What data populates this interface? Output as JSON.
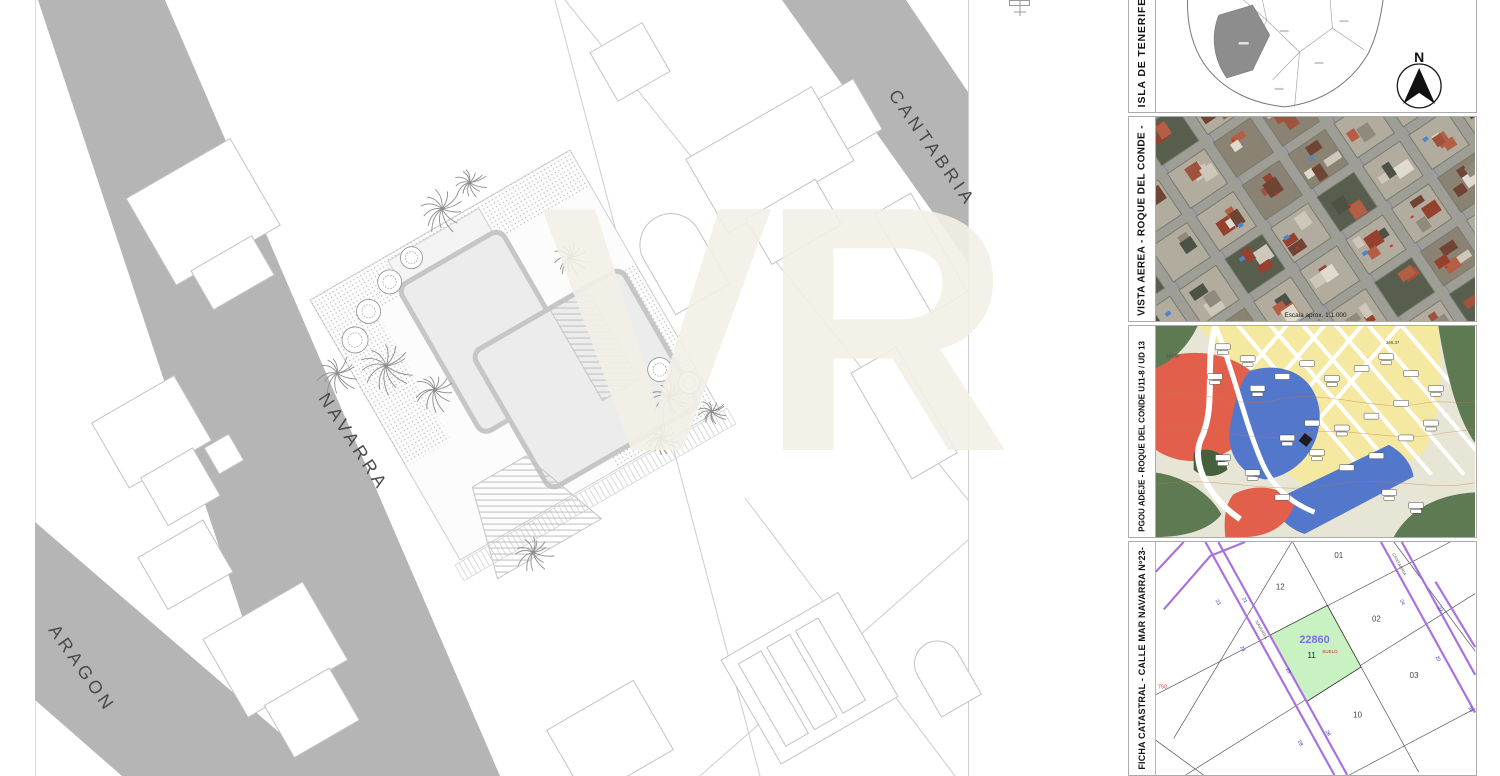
{
  "main_plan": {
    "streets": {
      "cantabria": "CANTABRIA",
      "navarra": "NAVARRA",
      "aragon": "ARAGON"
    },
    "watermark": "VR"
  },
  "panels": {
    "tenerife": {
      "label": "ISLA DE TENERIFE",
      "compass": "N"
    },
    "aerial": {
      "label": "VISTA AEREA - ROQUE DEL CONDE -",
      "scale_note": "Escala aprox. 1:1.000"
    },
    "pgou": {
      "label": "PGOU ADEJE - ROQUE DEL CONDE U11-8 / UD 13",
      "elevations": [
        "247.55",
        "346.37"
      ]
    },
    "catastral": {
      "label": "FICHA CATASTRAL - CALLE MAR NAVARRA Nº23-",
      "parcel_ref": "22860",
      "parcel_status": "SUELO",
      "parcel_number": "11",
      "parcel_labels": [
        "01",
        "12",
        "02",
        "03",
        "10"
      ],
      "street_names": {
        "navarra": "NAVARRA",
        "cantabria": "CANTABRIA"
      },
      "house_numbers": [
        "23",
        "21",
        "24",
        "23",
        "26",
        "28",
        "24",
        "27",
        "20",
        "20"
      ],
      "edge_ref": "750"
    }
  },
  "colors": {
    "street_gray": "#b5b5b5",
    "zoning_yellow": "#f5e9a2",
    "zoning_blue": "#5377cb",
    "zoning_red": "#e2604b",
    "zoning_green": "#5d7a52",
    "cadastral_purple": "#a970e0",
    "cadastral_parcel_green": "#c9f2c3",
    "cadastral_ref_blue": "#7b6fe0"
  }
}
